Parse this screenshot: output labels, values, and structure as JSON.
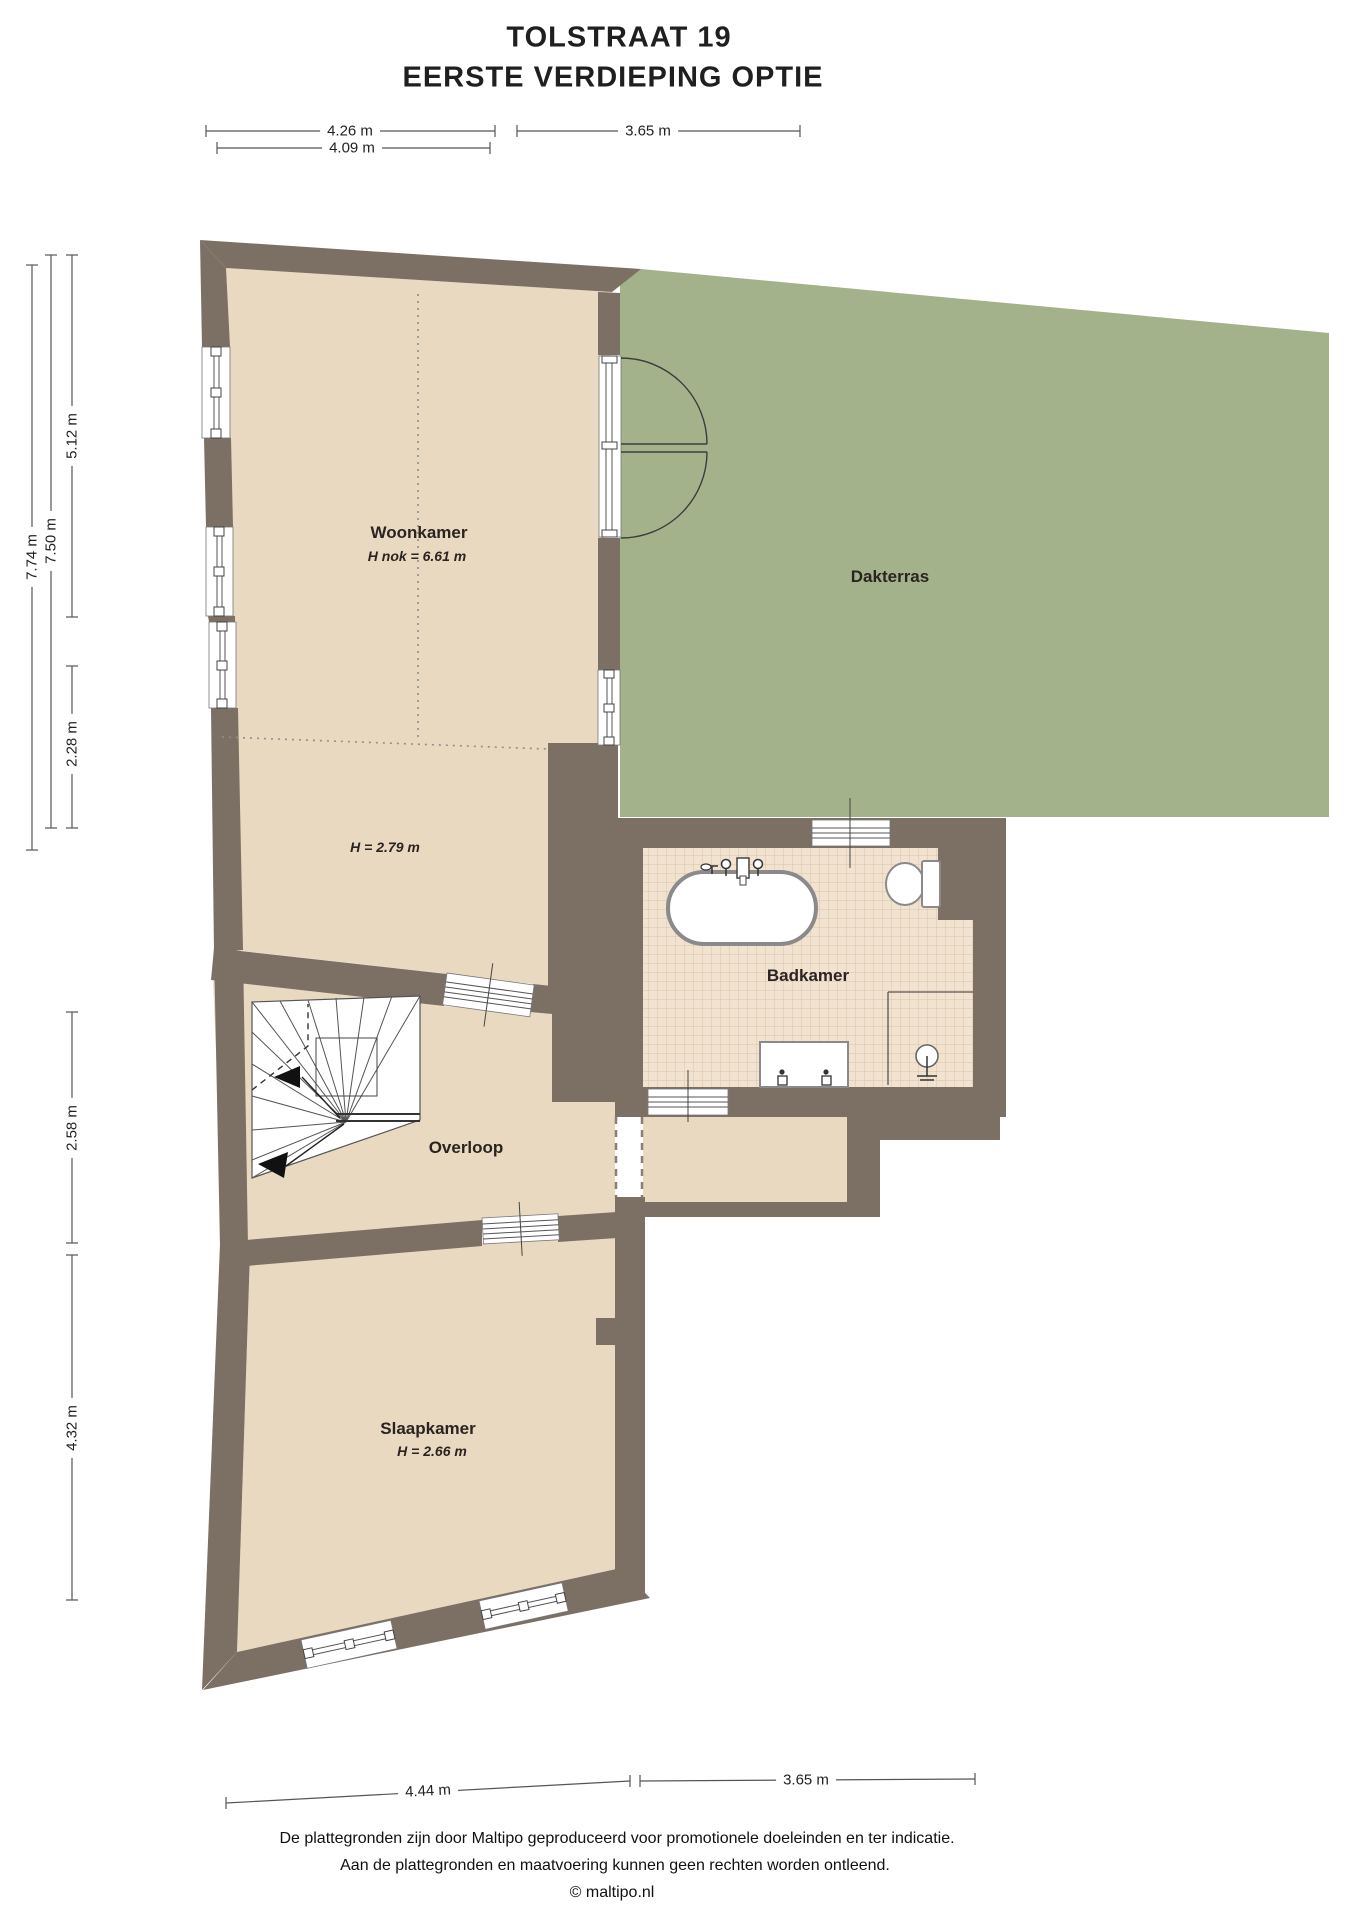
{
  "title": {
    "line1": "TOLSTRAAT 19",
    "line2": "EERSTE VERDIEPING OPTIE"
  },
  "rooms": {
    "woonkamer": {
      "name": "Woonkamer",
      "note": "H nok = 6.61 m"
    },
    "woonkamer_laag": {
      "note": "H = 2.79 m"
    },
    "dakterras": {
      "name": "Dakterras"
    },
    "badkamer": {
      "name": "Badkamer"
    },
    "overloop": {
      "name": "Overloop"
    },
    "slaapkamer": {
      "name": "Slaapkamer",
      "note": "H = 2.66 m"
    }
  },
  "dimensions": {
    "top": [
      "4.26 m",
      "4.09 m",
      "3.65 m"
    ],
    "left": [
      "7.74 m",
      "7.50 m",
      "5.12 m",
      "2.28 m",
      "2.58 m",
      "4.32 m"
    ],
    "bottom": [
      "4.44 m",
      "3.65 m"
    ]
  },
  "footer": {
    "line1": "De plattegronden zijn door Maltipo geproduceerd voor promotionele doeleinden en ter indicatie.",
    "line2": "Aan de plattegronden en maatvoering kunnen geen rechten worden ontleend.",
    "line3": "© maltipo.nl"
  },
  "colors": {
    "wall": "#7c7065",
    "floor": "#e9d9c1",
    "terrace": "#a4b28c",
    "tile": "#f2e3d0",
    "tileline": "#d9c3a8",
    "fixture": "#8a8a8a",
    "dimline": "#555555"
  },
  "fixtures": [
    "bathtub-icon",
    "toilet-icon",
    "washbasin-icon",
    "shower-icon",
    "stairs-icon",
    "french-doors-icon",
    "window-icon"
  ]
}
